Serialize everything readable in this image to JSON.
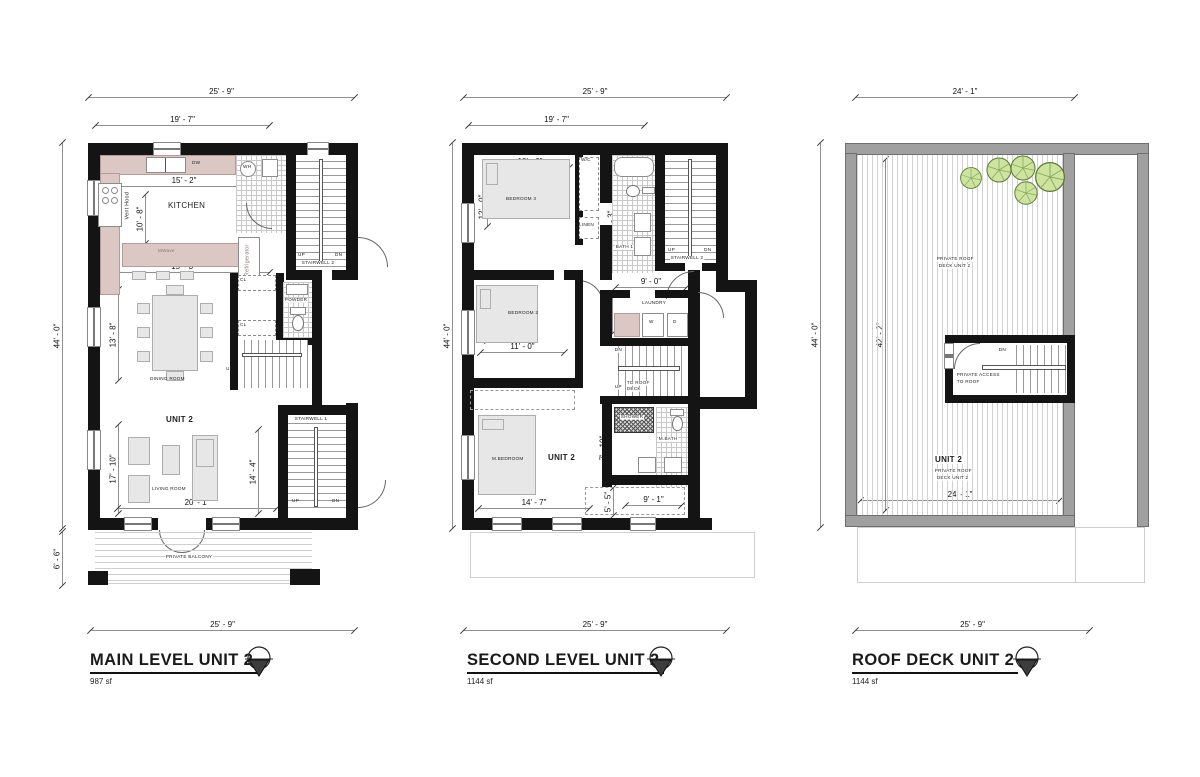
{
  "plans": {
    "main": {
      "title": "MAIN LEVEL UNIT 2",
      "area": "987 sf",
      "dims": {
        "top": "25' - 9\"",
        "top_inner": "19' - 7\"",
        "left": "44' - 0\"",
        "balcony_left": "6' - 6\"",
        "kitchen_w": "15' - 2\"",
        "kitchen_h": "10' - 8\"",
        "dining_w": "15' - 3\"",
        "dining_h": "13' - 8\"",
        "living_h": "17' - 10\"",
        "stair_h": "14' - 4\"",
        "living_w": "20' - 1\"",
        "bottom": "25' - 9\""
      },
      "labels": {
        "kitchen": "KITCHEN",
        "mwave": "MWave",
        "vent_hood": "Vent Hood",
        "refrigerator": "Refrigerator",
        "dw": "DW",
        "wh": "WH",
        "stairwell2": "STAIRWELL 2",
        "powder": "POWDER",
        "cl": "CL",
        "up": "UP",
        "dn": "DN",
        "dining_room": "DINING ROOM",
        "unit": "UNIT 2",
        "living_room": "LIVING ROOM",
        "stairwell1": "STAIRWELL 1",
        "private_balcony": "PRIVATE BALCONY"
      }
    },
    "second": {
      "title": "SECOND LEVEL UNIT 2",
      "area": "1144 sf",
      "dims": {
        "top": "25' - 9\"",
        "top_inner": "19' - 7\"",
        "left": "44' - 0\"",
        "bedroom3_w": "10' - 6\"",
        "bedroom3_h": "12' - 0\"",
        "tub": "5' - 0\"",
        "bath1_h": "13' - 3\"",
        "bedroom2_h": "12' - 0\"",
        "bedroom2_w": "11' - 0\"",
        "laundry_w": "9' - 0\"",
        "laundry_h": "7' - 6\"",
        "mbedroom_h": "15' - 3\"",
        "mbath_h": "7' - 10\"",
        "bottom_left": "14' - 7\"",
        "closet_h": "5' - 5\"",
        "bottom_right": "9' - 1\"",
        "bottom": "25' - 9\""
      },
      "labels": {
        "bedroom3": "BEDROOM 3",
        "wc": "W/C",
        "linen": "LINEN",
        "bath1": "BATH 1",
        "stairwell2": "STAIRWELL 2",
        "bedroom2": "BEDROOM 2",
        "laundry": "LAUNDRY",
        "washer": "W",
        "dryer": "D",
        "dn": "DN",
        "up": "UP",
        "to_roof_l1": "TO ROOF",
        "to_roof_l2": "DECK",
        "mbedroom": "M.BEDROOM",
        "unit": "UNIT 2",
        "shower": "SHOWER",
        "mbath": "M.BATH"
      }
    },
    "roof": {
      "title": "ROOF DECK  UNIT 2",
      "area": "1144 sf",
      "dims": {
        "top": "24' - 1\"",
        "left": "44' - 0\"",
        "deck_h": "42' - 2\"",
        "deck_w": "24' - 1\"",
        "bottom": "25' - 9\""
      },
      "labels": {
        "deck_l1": "PRIVATE ROOF",
        "deck_l2": "DECK UNIT 2",
        "dn": "DN",
        "access_l1": "PRIVATE ACCESS",
        "access_l2": "TO ROOF",
        "unit": "UNIT 2"
      }
    }
  },
  "colors": {
    "wall": "#141414",
    "roof_wall": "#a0a0a0",
    "counter": "#dbc8c4",
    "furniture": "#e7e7e7",
    "tree_fill": "#cde39f",
    "tree_stroke": "#5b7a35"
  }
}
